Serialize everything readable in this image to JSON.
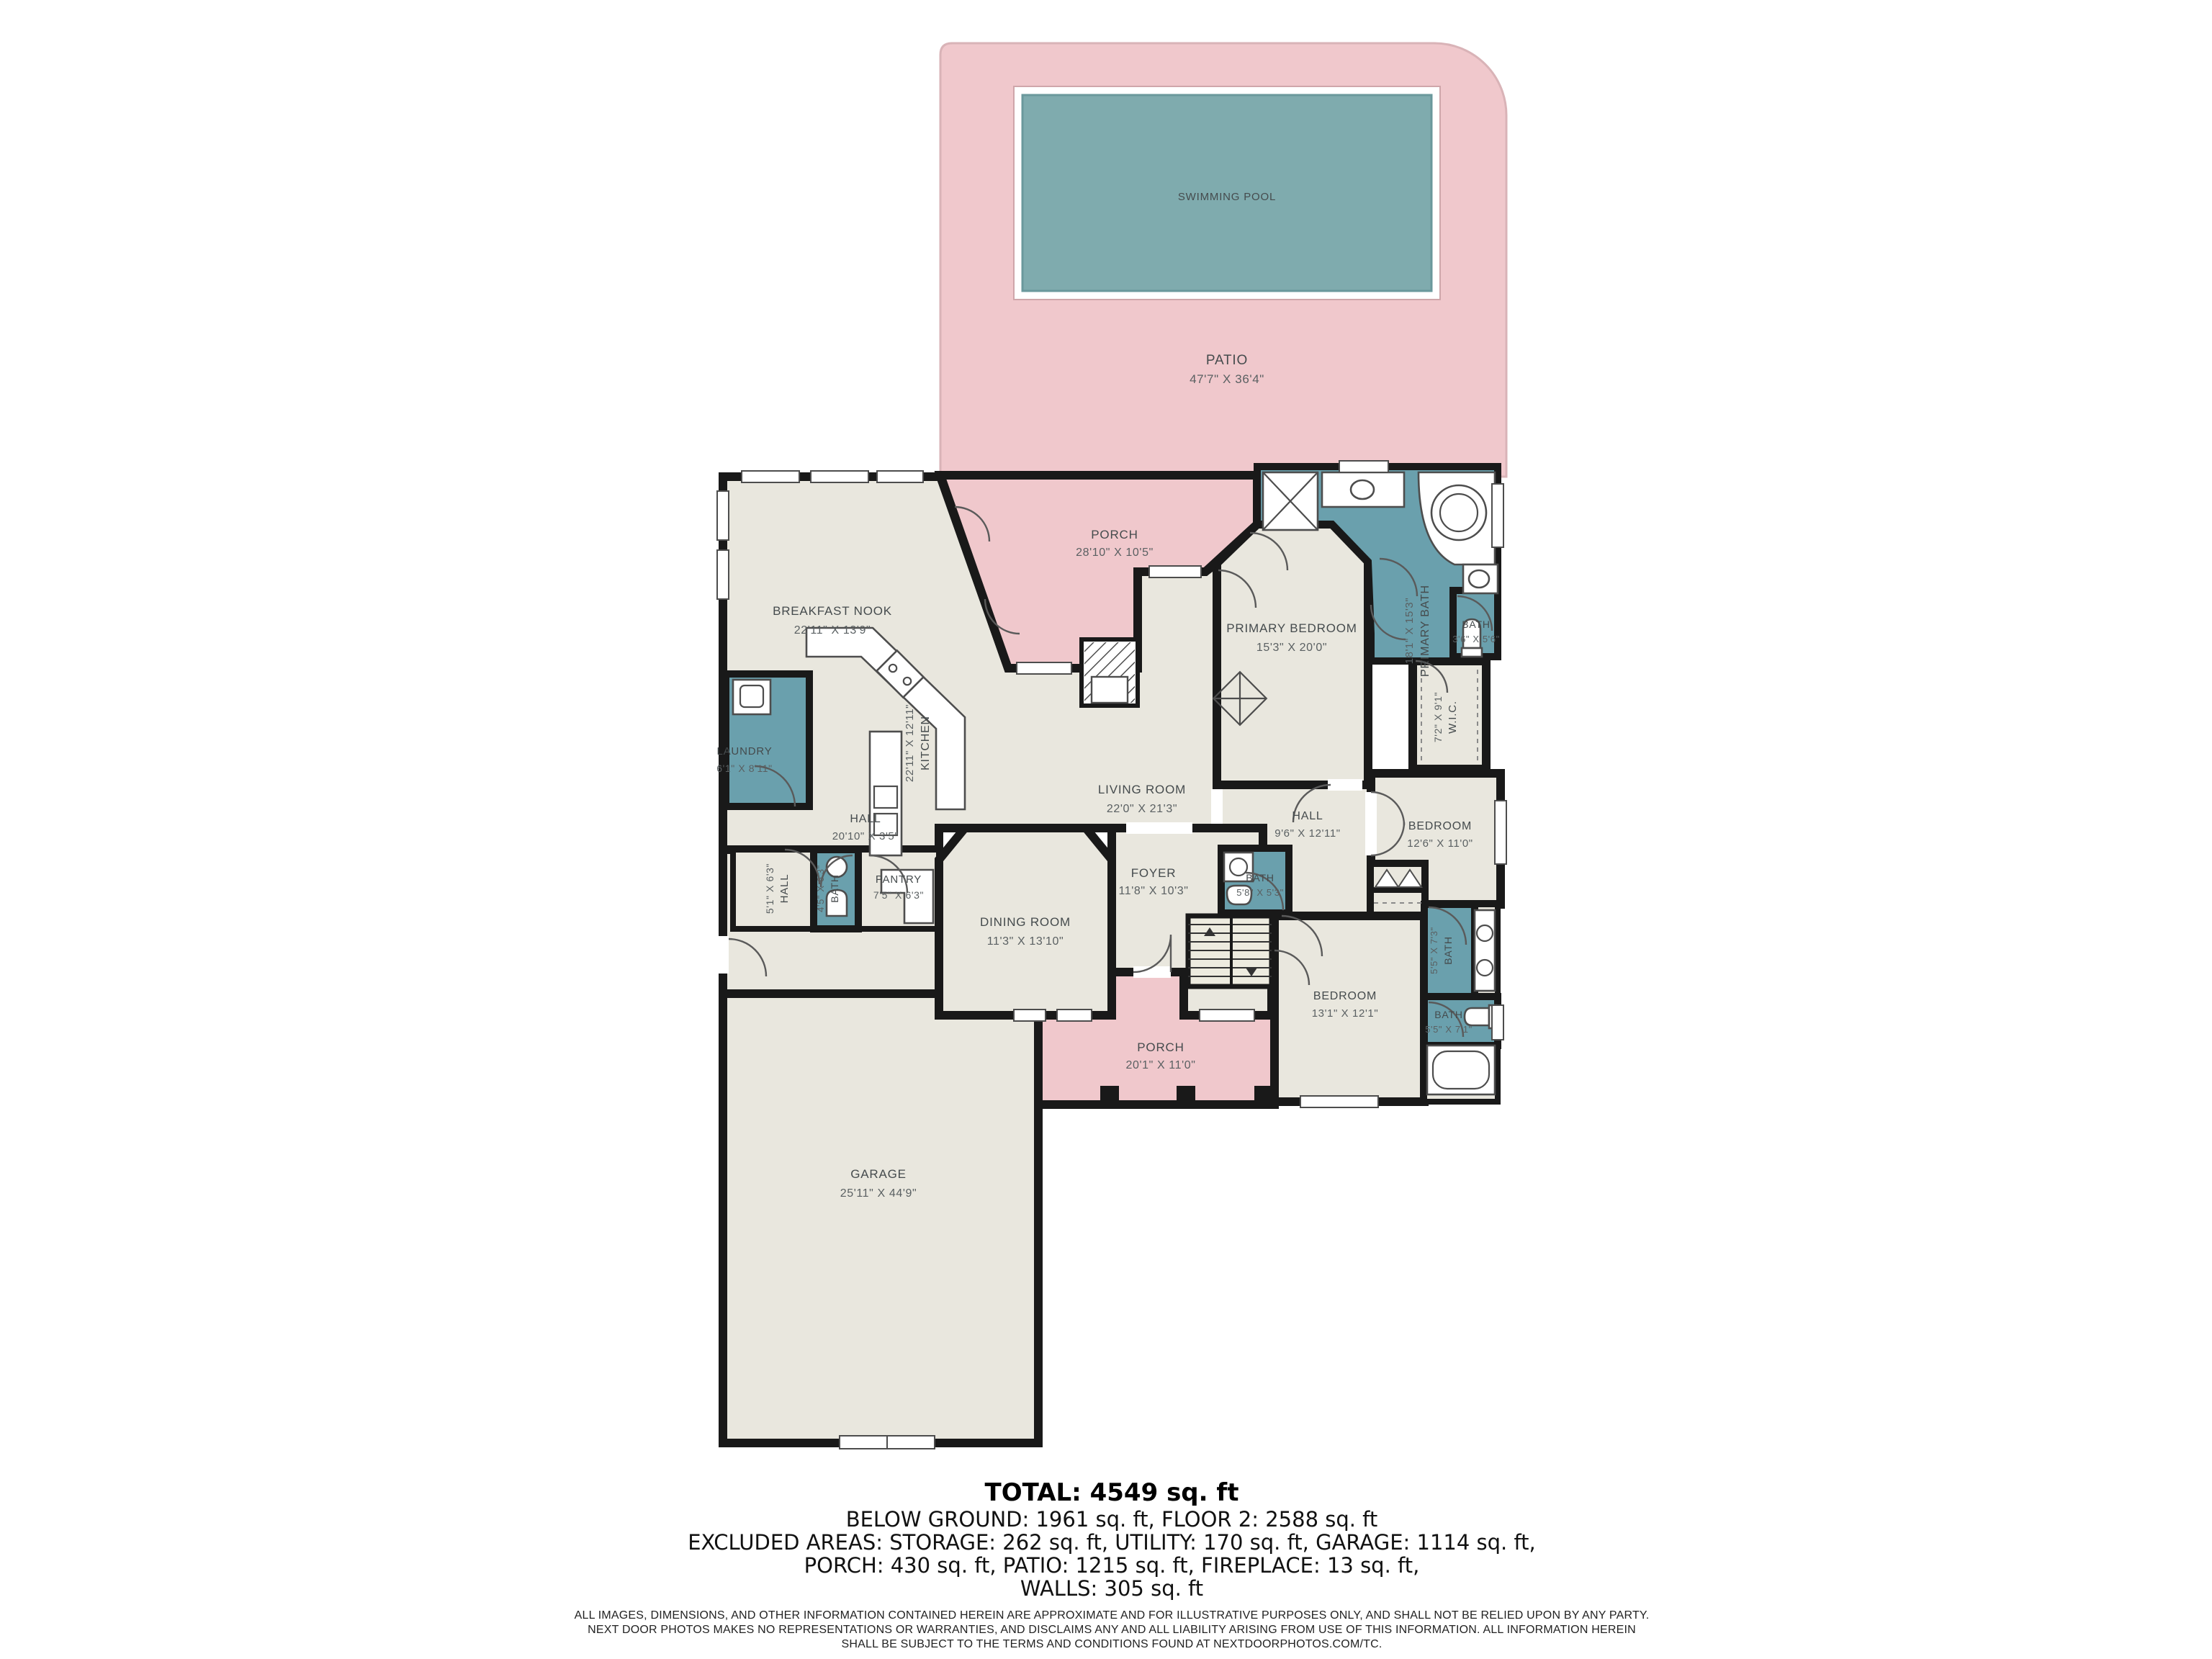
{
  "rooms": {
    "swimming_pool": {
      "name": "SWIMMING POOL"
    },
    "patio": {
      "name": "PATIO",
      "dims": "47'7\" X 36'4\""
    },
    "porch_top": {
      "name": "PORCH",
      "dims": "28'10\" X 10'5\""
    },
    "breakfast_nook": {
      "name": "BREAKFAST NOOK",
      "dims": "22'11\" X 13'9\""
    },
    "kitchen": {
      "name": "KITCHEN",
      "dims": "22'11\" X 12'11\""
    },
    "living_room": {
      "name": "LIVING ROOM",
      "dims": "22'0\" X 21'3\""
    },
    "laundry": {
      "name": "LAUNDRY",
      "dims": "6'1\" X 8'11\""
    },
    "hall_main": {
      "name": "HALL",
      "dims": "20'10\" X 3'5\""
    },
    "hall_small": {
      "name": "HALL",
      "dims": "5'1\" X 6'3\""
    },
    "bath_hall": {
      "name": "BATH",
      "dims": "4'5\" X 6'3\""
    },
    "pantry": {
      "name": "PANTRY",
      "dims": "7'5\" X 6'3\""
    },
    "dining_room": {
      "name": "DINING ROOM",
      "dims": "11'3\" X 13'10\""
    },
    "foyer": {
      "name": "FOYER",
      "dims": "11'8\" X 10'3\""
    },
    "porch_bottom": {
      "name": "PORCH",
      "dims": "20'1\" X 11'0\""
    },
    "garage": {
      "name": "GARAGE",
      "dims": "25'11\" X 44'9\""
    },
    "primary_bedroom": {
      "name": "PRIMARY BEDROOM",
      "dims": "15'3\" X 20'0\""
    },
    "primary_bath": {
      "name": "PRIMARY BATH",
      "dims": "18'1\" X 15'3\""
    },
    "bath_small": {
      "name": "BATH",
      "dims": "3'6\" X 5'6\""
    },
    "wic": {
      "name": "W.I.C.",
      "dims": "7'2\" X 9'1\""
    },
    "bedroom_right": {
      "name": "BEDROOM",
      "dims": "12'6\" X 11'0\""
    },
    "hall_bedrooms": {
      "name": "HALL",
      "dims": "9'6\" X 12'11\""
    },
    "bath_foyer": {
      "name": "BATH",
      "dims": "5'8\" X 5'3\""
    },
    "bath_jack": {
      "name": "BATH",
      "dims": "5'5\" X 7'3\""
    },
    "bedroom_bottom": {
      "name": "BEDROOM",
      "dims": "13'1\" X 12'1\""
    },
    "bath_bottom": {
      "name": "BATH",
      "dims": "5'5\" X 7'1\""
    }
  },
  "summary": {
    "total": "TOTAL: 4549 sq. ft",
    "line1": "BELOW GROUND: 1961 sq. ft, FLOOR 2: 2588 sq. ft",
    "line2": "EXCLUDED AREAS: STORAGE: 262 sq. ft, UTILITY: 170 sq. ft, GARAGE: 1114 sq. ft,",
    "line3": "PORCH: 430 sq. ft, PATIO: 1215 sq. ft, FIREPLACE: 13 sq. ft,",
    "line4": "WALLS: 305 sq. ft"
  },
  "disclaimer": {
    "line1": "ALL IMAGES, DIMENSIONS, AND OTHER INFORMATION CONTAINED HEREIN ARE APPROXIMATE AND FOR ILLUSTRATIVE PURPOSES ONLY, AND SHALL NOT BE RELIED UPON BY ANY PARTY.",
    "line2": "NEXT DOOR PHOTOS MAKES NO REPRESENTATIONS OR WARRANTIES, AND DISCLAIMS ANY AND ALL LIABILITY ARISING FROM USE OF THIS INFORMATION. ALL INFORMATION HEREIN",
    "line3": "SHALL BE SUBJECT TO THE TERMS AND CONDITIONS FOUND AT NEXTDOORPHOTOS.COM/TC."
  },
  "colors": {
    "patio_pink": "#f0c8cc",
    "pool_teal": "#7fabae",
    "bath_teal": "#6aa0ad",
    "floor": "#e9e7de",
    "wall": "#191919"
  }
}
